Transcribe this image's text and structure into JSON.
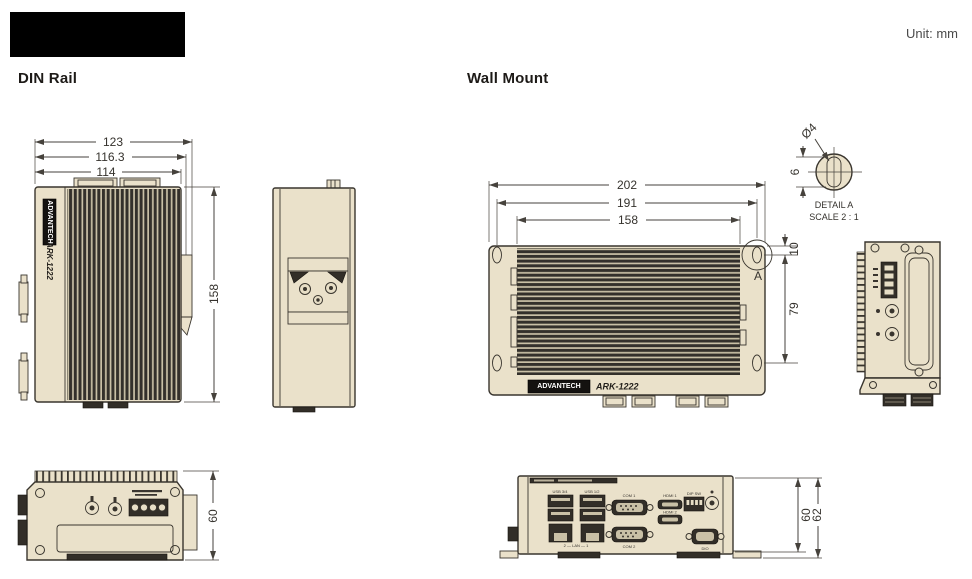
{
  "header": {
    "unit_label": "Unit: mm"
  },
  "sections": {
    "din_rail_title": "DIN Rail",
    "wall_mount_title": "Wall Mount"
  },
  "brand": {
    "name": "ADVANTECH",
    "model": "ARK-1222"
  },
  "din_front": {
    "dim_overall_width": "123",
    "dim_mid_width": "116.3",
    "dim_body_width": "114",
    "dim_height": "158"
  },
  "din_bottom": {
    "dim_depth": "60"
  },
  "wall_front": {
    "dim_overall_width": "202",
    "dim_hole_span": "191",
    "dim_body_width": "158",
    "dim_hole_top_offset": "10",
    "dim_hole_vspan": "79",
    "detail_marker": "A"
  },
  "detail_a": {
    "dim_hole_dia": "Ø4",
    "dim_slot_height": "6",
    "label": "DETAIL A",
    "scale_label": "SCALE 2 : 1"
  },
  "wall_bottom": {
    "dim_body_depth": "60",
    "dim_overall_depth": "62",
    "port_labels": {
      "usb_left": "USB 3/4",
      "usb_right": "USB 1/2",
      "lan": "2 — LAN — 1",
      "com1": "COM 1",
      "com2": "COM 2",
      "hdmi1": "HDMI 1",
      "hdmi2": "HDMI 2",
      "dip": "DIP SW",
      "dio": "DIO"
    }
  }
}
